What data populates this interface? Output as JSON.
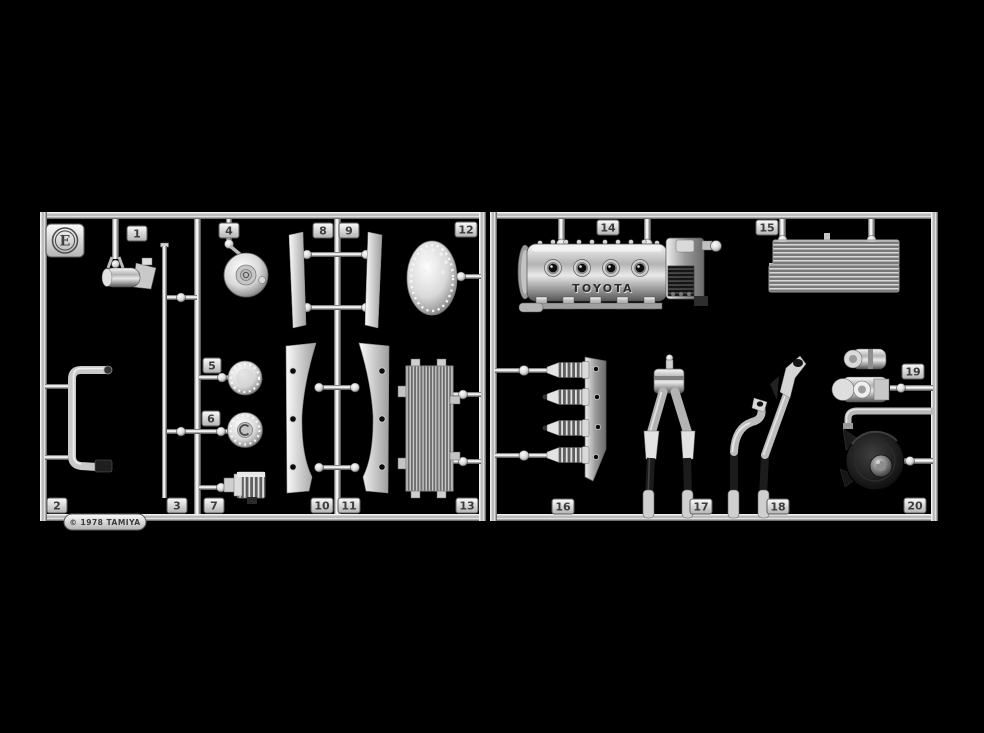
{
  "sprue": {
    "letter": "E",
    "copyright": "© 1978 TAMIYA",
    "engine_brand": "TOYOTA",
    "part_numbers": [
      "1",
      "2",
      "3",
      "4",
      "5",
      "6",
      "7",
      "8",
      "9",
      "10",
      "11",
      "12",
      "13",
      "14",
      "15",
      "16",
      "17",
      "18",
      "19",
      "20"
    ],
    "colors": {
      "background": "#000000",
      "chrome_highlight": "#f5f5f5",
      "chrome_mid": "#9a9a9a",
      "chrome_shadow": "#3c3c3c"
    }
  }
}
